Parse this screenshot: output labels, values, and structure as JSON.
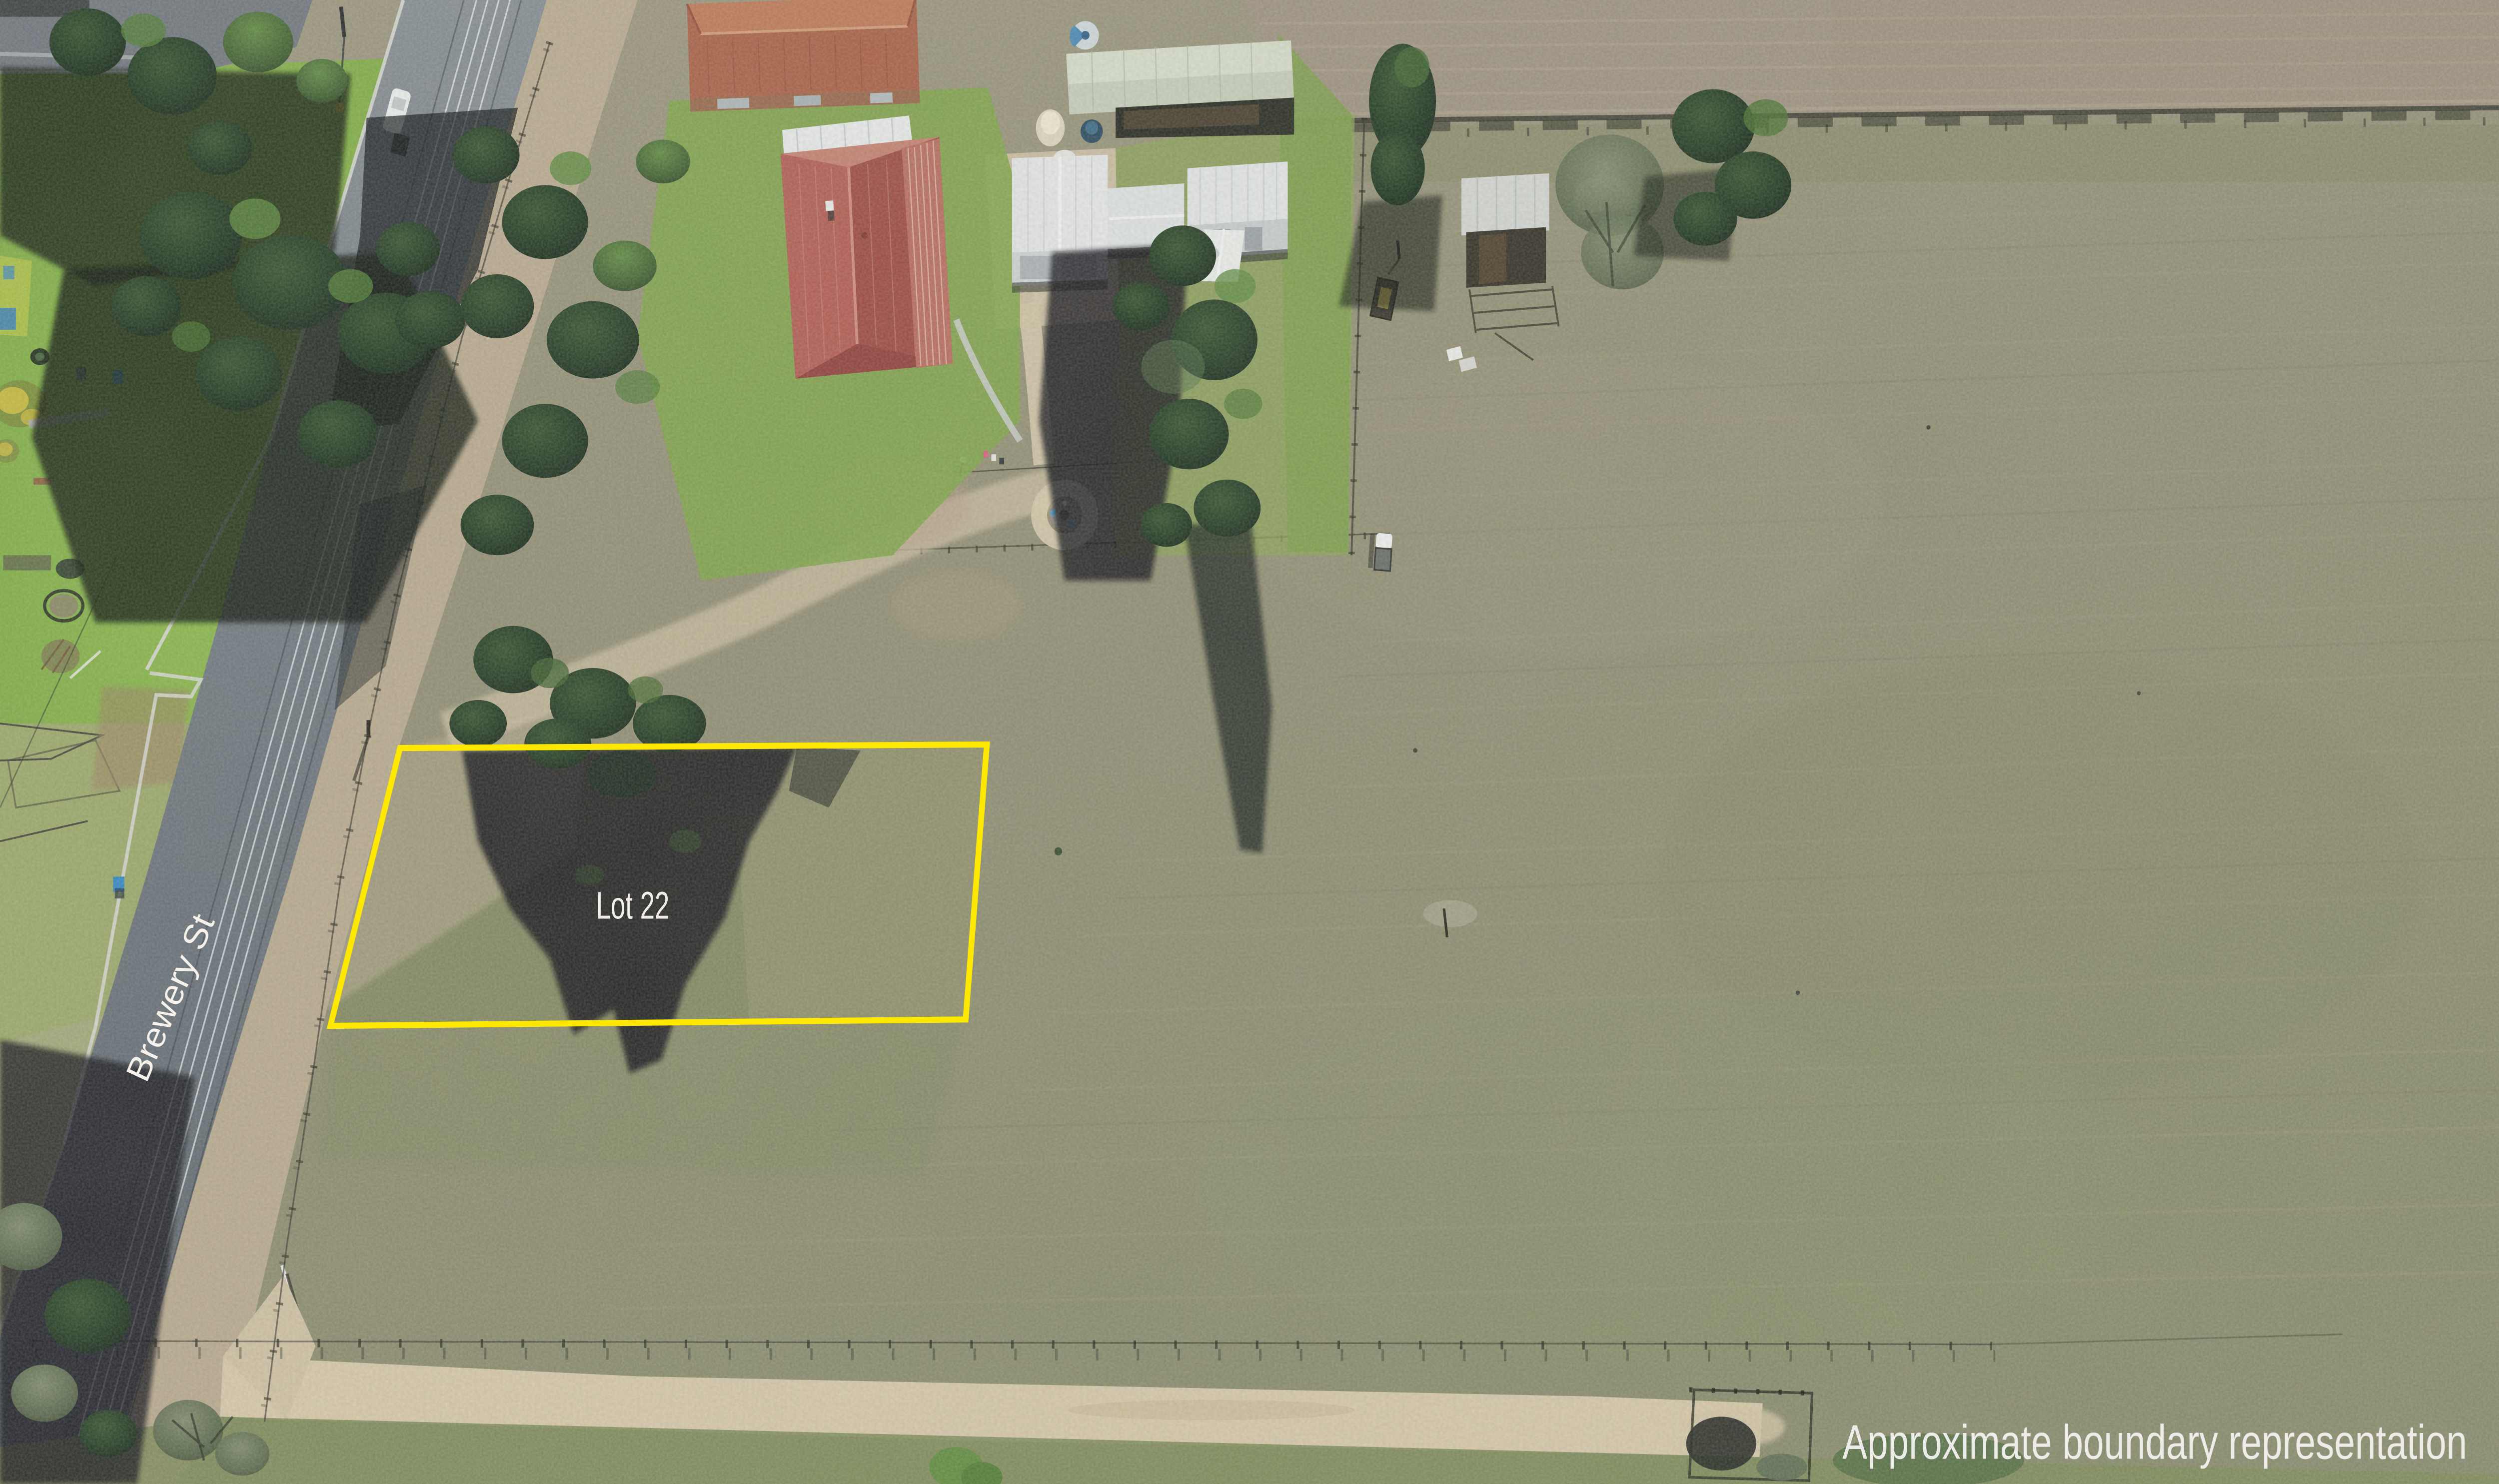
{
  "image": {
    "kind": "aerial-drone-photo",
    "labels": {
      "lot": "Lot 22",
      "street": "Brewery St",
      "caption": "Approximate boundary representation"
    },
    "boundary": {
      "color": "#ffe800",
      "shape": "quadrilateral"
    },
    "colors": {
      "label_text": "#f3eeea",
      "asphalt": "#6b747d",
      "kerb_concrete": "#d8d9d6",
      "lawn_green": "#76a13f",
      "paddock_olive": "#918d74",
      "tilled_field": "#9c9181",
      "dirt_track": "#d6c8aa",
      "gravel_shoulder": "#bcab93",
      "roof_red": "#a95048",
      "roof_tile_terracotta": "#a85f46",
      "shed_white": "#e6e8e9",
      "shed_sage": "#c6cdbb",
      "tank_blue": "#4a88b8",
      "tree_dark": "#16281a",
      "shadow_dark": "#0a0f14",
      "wheelie_bin_blue": "#3a8fd0"
    }
  }
}
